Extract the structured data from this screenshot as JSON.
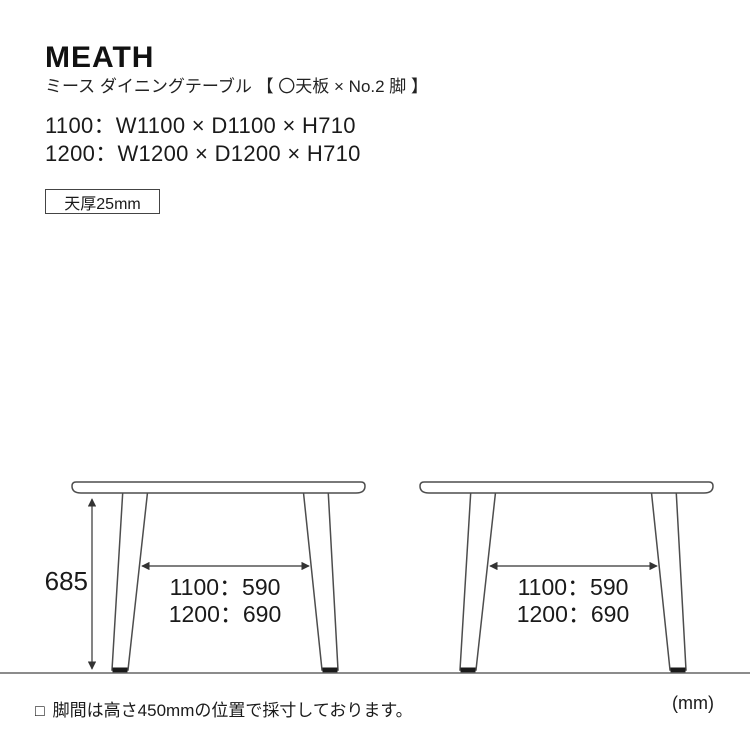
{
  "header": {
    "title": "MEATH",
    "subtitle": "ミース ダイニングテーブル 【 〇天板 × No.2 脚 】",
    "spec_lines": [
      "1100：W1100 × D1100 × H710",
      "1200：W1200 × D1200 × H710"
    ],
    "thickness_badge": "天厚25mm"
  },
  "diagram": {
    "height_label": "685",
    "left_table": {
      "span_1100": "1100：590",
      "span_1200": "1200：690"
    },
    "right_table": {
      "span_1100": "1100：590",
      "span_1200": "1200：690"
    }
  },
  "footer": {
    "note_bullet": "□",
    "note_text": "脚間は高さ450mmの位置で採寸しております。",
    "unit_label": "(mm)"
  },
  "colors": {
    "outline": "#4d4d4d",
    "dimension": "#333333",
    "ground": "#8c8c8c",
    "foot": "#1a1a1a",
    "text": "#1a1a1a"
  }
}
